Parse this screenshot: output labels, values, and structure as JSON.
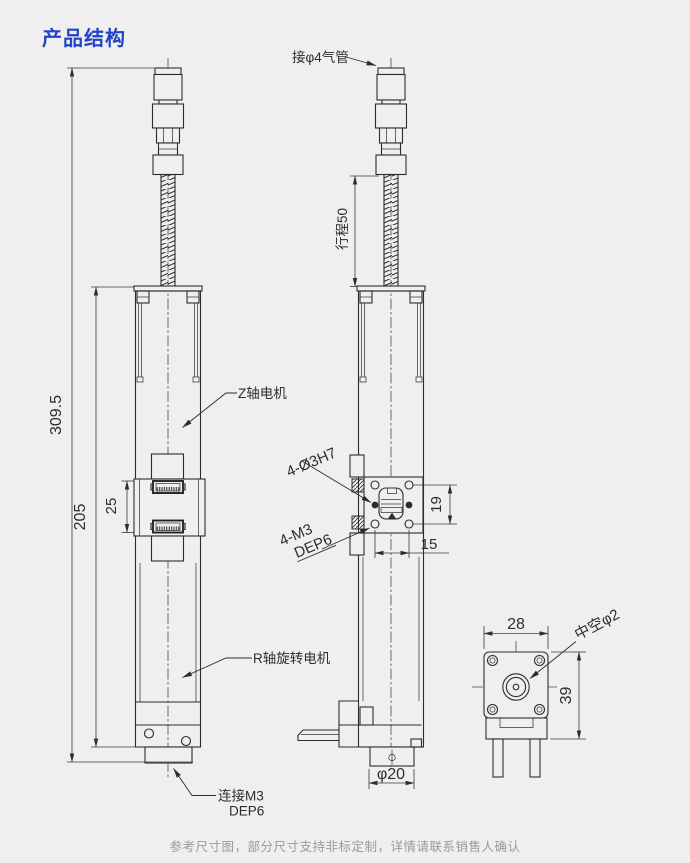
{
  "title": "产品结构",
  "footer_note": "参考尺寸图，部分尺寸支持非标定制，详情请联系销售人确认",
  "colors": {
    "background": "#efefef",
    "title_blue": "#2243c5",
    "line_dark": "#2d2d2d",
    "footer_gray": "#9a9a9a"
  },
  "labels": {
    "air_fitting": "接φ4气管",
    "stroke_dim": "行程50",
    "z_axis_motor": "Z轴电机",
    "r_axis_motor": "R轴旋转电机",
    "mount_holes_ream": "4-Ø3H7",
    "mount_holes_tap": "4-M3",
    "mount_holes_tap_depth": "DEP6",
    "bottom_thread_line1": "连接M3",
    "bottom_thread_line2": "DEP6",
    "hollow_bore": "中空φ2"
  },
  "dimensions": {
    "overall_height": "309.5",
    "body_height": "205",
    "connector_pitch": "25",
    "hole_pitch_vertical": "19",
    "hole_pitch_horizontal": "15",
    "output_flange_dia": "φ20",
    "motor_width": "28",
    "motor_height": "39"
  }
}
